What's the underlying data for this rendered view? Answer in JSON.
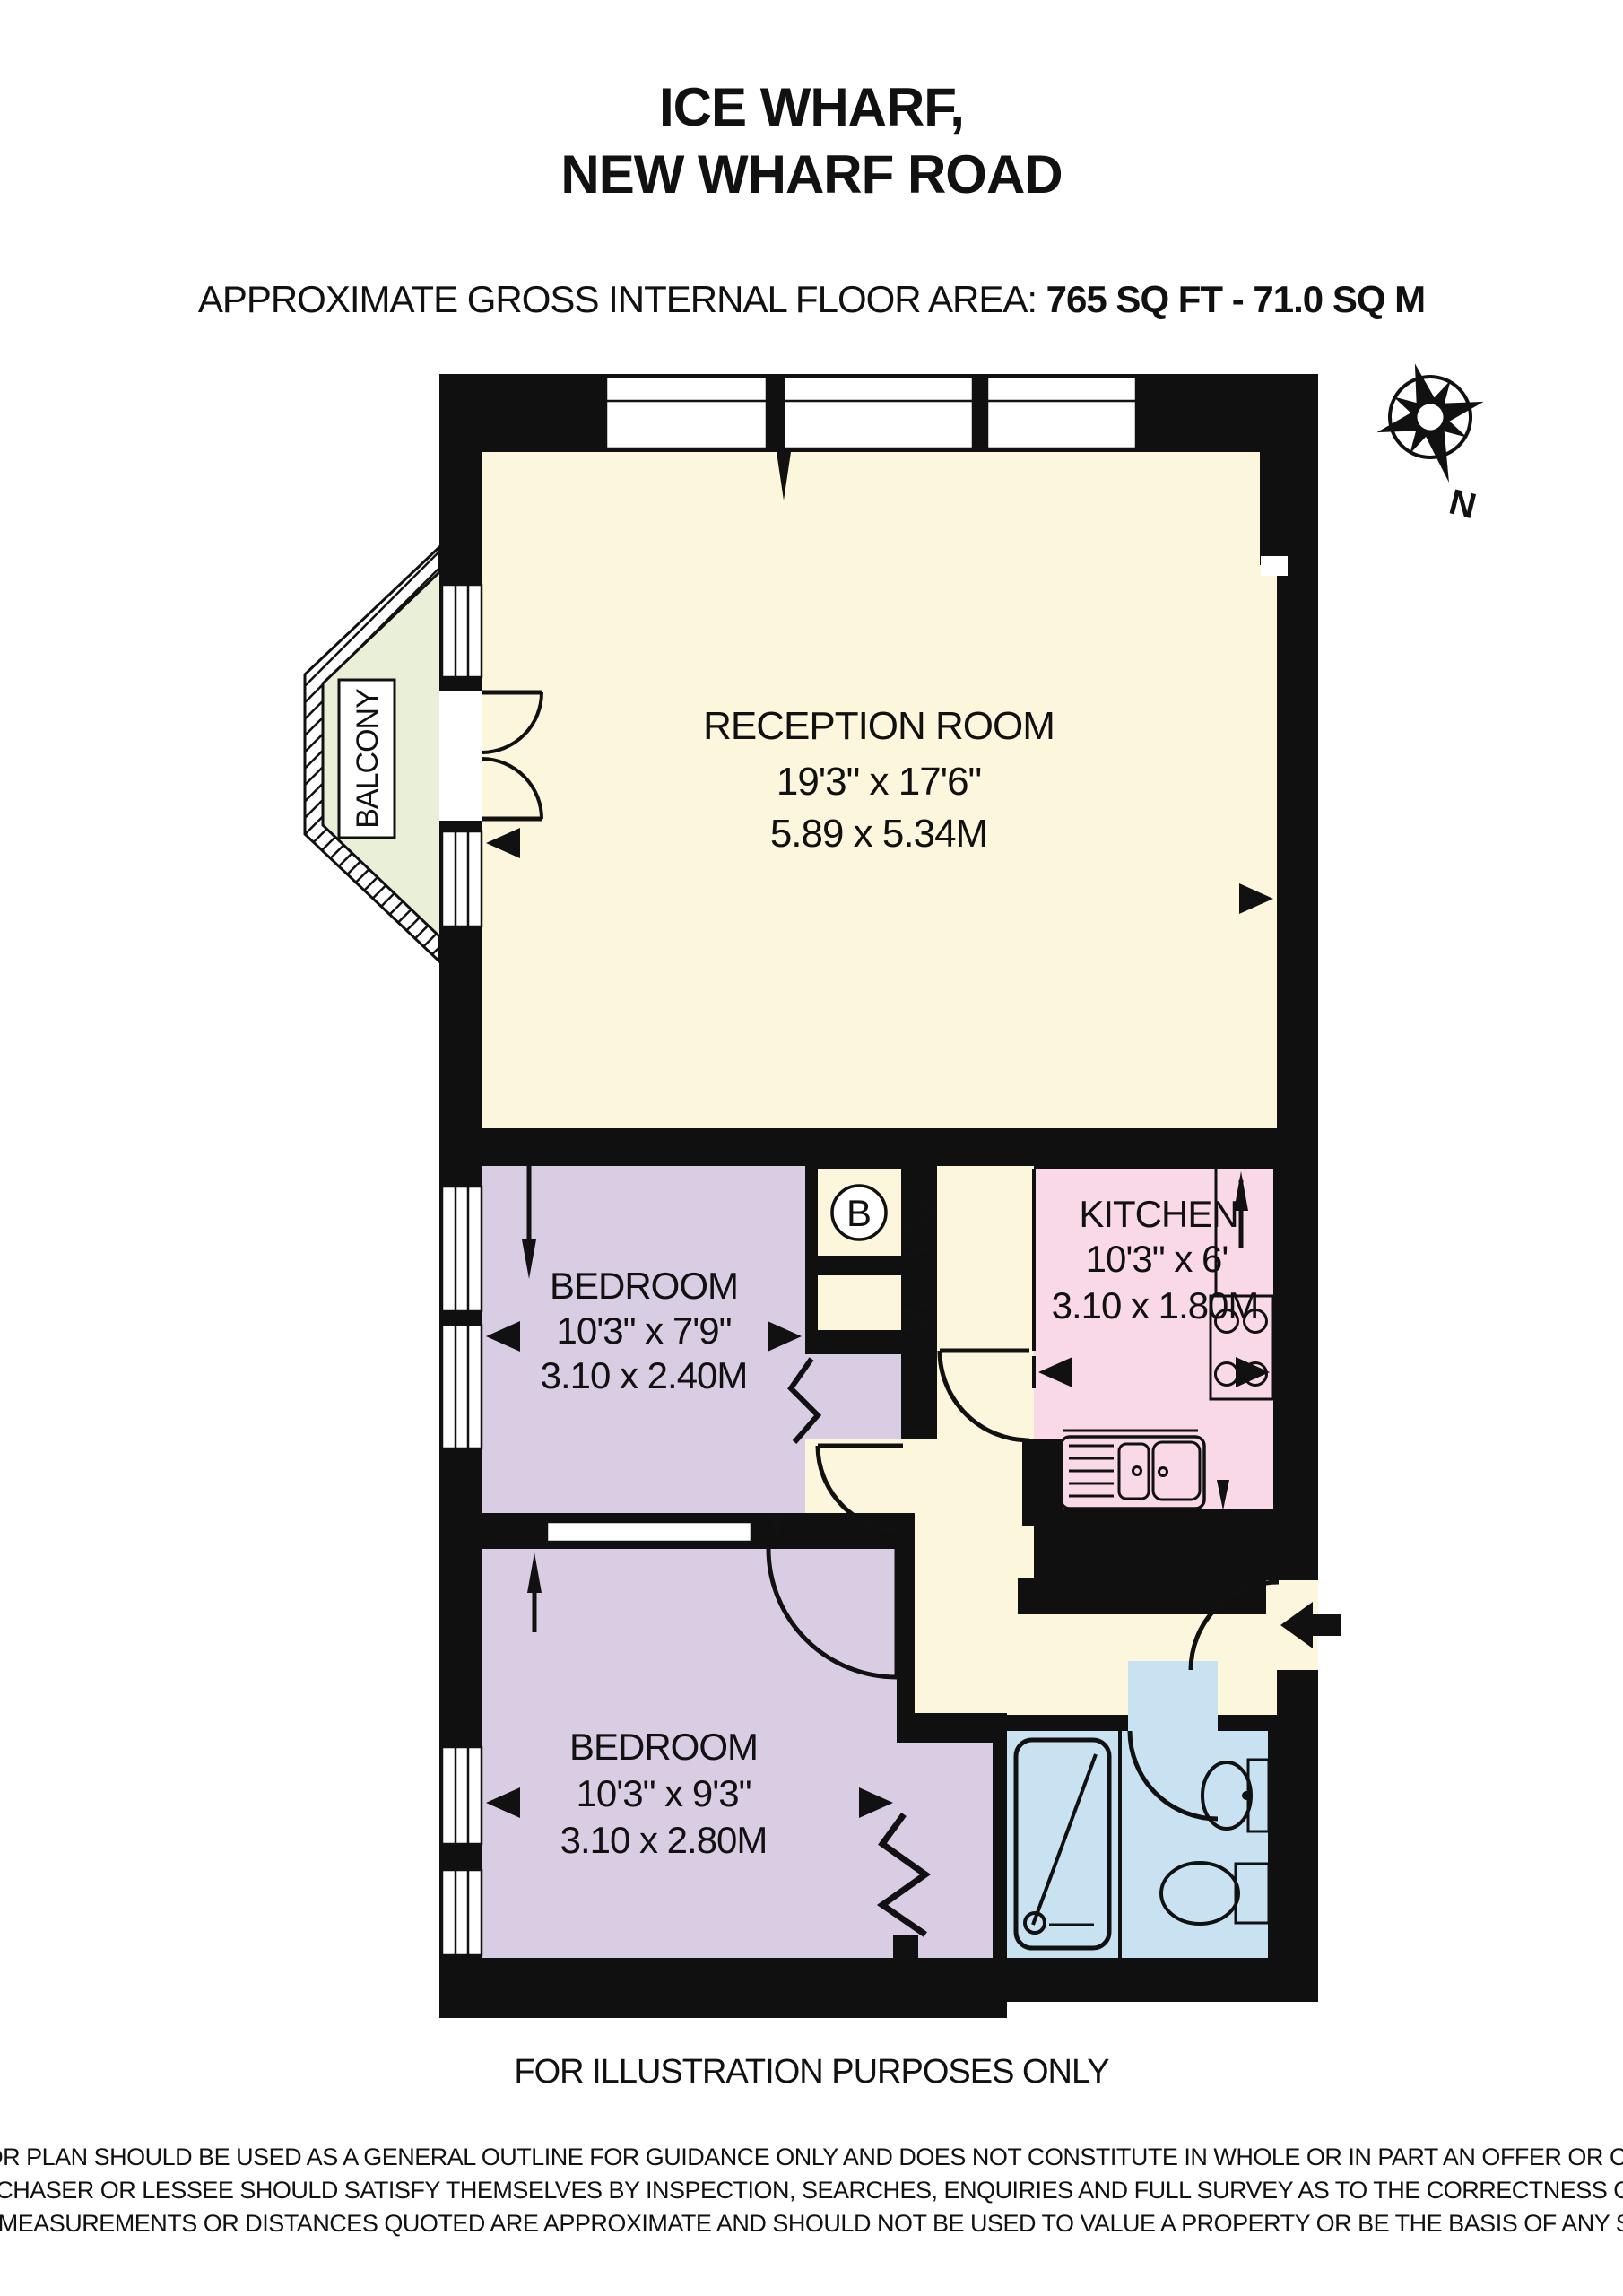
{
  "title": {
    "line1": "ICE WHARF,",
    "line2": "NEW WHARF ROAD"
  },
  "area": {
    "label": "APPROXIMATE GROSS INTERNAL FLOOR AREA:",
    "value": " 765 SQ FT  -  71.0 SQ M"
  },
  "compass": {
    "north_label": "N"
  },
  "rooms": {
    "reception": {
      "name": "RECEPTION ROOM",
      "imperial": "19'3\" x 17'6\"",
      "metric": "5.89 x 5.34M"
    },
    "kitchen": {
      "name": "KITCHEN",
      "imperial": "10'3\" x 6'",
      "metric": "3.10 x 1.80M"
    },
    "bedroom1": {
      "name": "BEDROOM",
      "imperial": "10'3\" x 7'9\"",
      "metric": "3.10 x 2.40M"
    },
    "bedroom2": {
      "name": "BEDROOM",
      "imperial": "10'3\" x 9'3\"",
      "metric": "3.10 x 2.80M"
    },
    "balcony": {
      "label": "BALCONY"
    },
    "boiler": {
      "label": "B"
    }
  },
  "footer": {
    "note": "FOR ILLUSTRATION PURPOSES ONLY",
    "disclaimer1": "THIS FLOOR PLAN SHOULD BE USED AS A GENERAL OUTLINE FOR GUIDANCE ONLY AND DOES NOT CONSTITUTE IN WHOLE OR IN PART AN OFFER OR CONTRACT.",
    "disclaimer2": "ANY INTENDING PURCHASER OR LESSEE SHOULD SATISFY THEMSELVES BY INSPECTION, SEARCHES, ENQUIRIES AND FULL SURVEY AS TO THE CORRECTNESS OF EACH STATEMENT.",
    "disclaimer3": "ANY AREAS, MEASUREMENTS OR DISTANCES QUOTED ARE APPROXIMATE AND SHOULD NOT BE USED TO VALUE A PROPERTY OR BE THE BASIS OF ANY SALE OR LET."
  },
  "colors": {
    "wall": "#101010",
    "reception_floor": "#FBF6DC",
    "bedroom_floor": "#D9CDE3",
    "kitchen_floor": "#F9D8E8",
    "bathroom_floor": "#C9E2F2",
    "balcony_floor": "#EAF0D8"
  }
}
